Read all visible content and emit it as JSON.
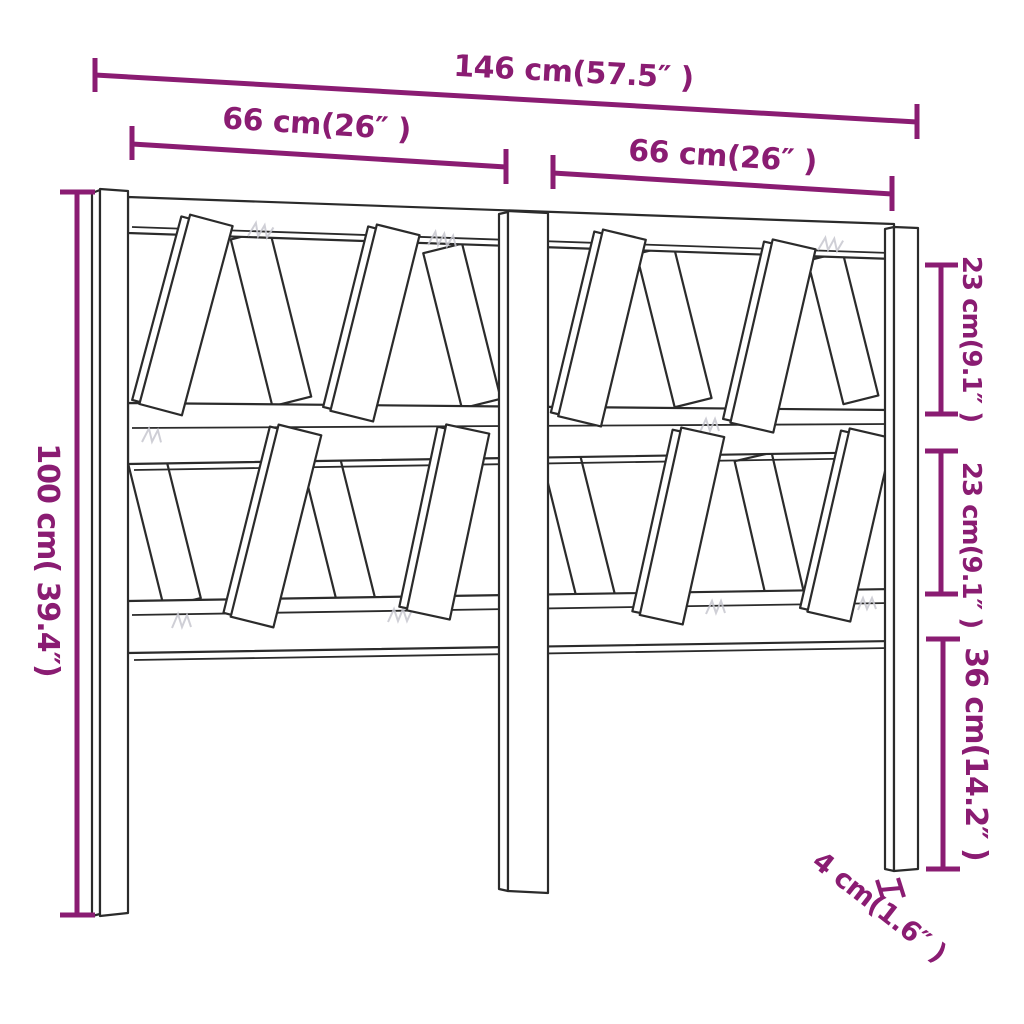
{
  "page": {
    "background": "#ffffff"
  },
  "diagram": {
    "title": "Headboard dimension line drawing",
    "accent_color": "#8a1c72",
    "line_color": "#2b2b2b",
    "labels": {
      "total_width": "146 cm(57.5″ )",
      "left_section_width": "66 cm(26″ )",
      "right_section_width": "66 cm(26″ )",
      "total_height": "100 cm( 39.4″)",
      "upper_gap": "23 cm(9.1″ )",
      "lower_gap": "23 cm(9.1″ )",
      "leg_height": "36 cm(14.2″ )",
      "post_thickness": "4 cm(1.6″ )"
    }
  }
}
